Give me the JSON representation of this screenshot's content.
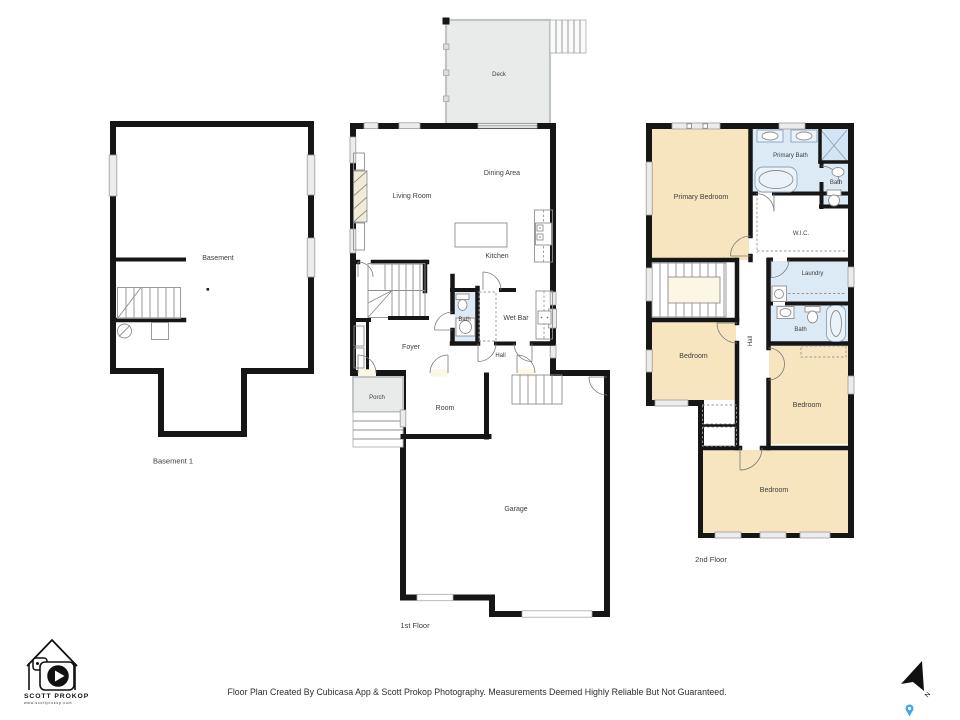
{
  "floors": {
    "basement": {
      "label": "Basement 1",
      "rooms": {
        "basement": "Basement"
      }
    },
    "first": {
      "label": "1st Floor",
      "rooms": {
        "deck": "Deck",
        "living_room": "Living Room",
        "dining_area": "Dining Area",
        "kitchen": "Kitchen",
        "bath": "Bath",
        "wet_bar": "Wet Bar",
        "foyer": "Foyer",
        "hall": "Hall",
        "porch": "Porch",
        "room": "Room",
        "garage": "Garage"
      }
    },
    "second": {
      "label": "2nd Floor",
      "rooms": {
        "primary_bedroom": "Primary Bedroom",
        "primary_bath": "Primary Bath",
        "bath_ensuite": "Bath",
        "wic": "W.I.C.",
        "laundry": "Laundry",
        "bath": "Bath",
        "bedroom_left": "Bedroom",
        "hall": "Hall",
        "bedroom_right": "Bedroom",
        "bedroom_bottom": "Bedroom"
      }
    }
  },
  "footer": {
    "disclaimer": "Floor Plan Created By Cubicasa App & Scott Prokop Photography. Measurements Deemed Highly Reliable But Not Guaranteed."
  },
  "logo": {
    "name": "SCOTT PROKOP",
    "website": "www.scottprokop.com"
  },
  "compass": {
    "north_label": "N"
  },
  "colors": {
    "room_fill": "#FBF7E4",
    "bedroom_fill": "#F6E5BE",
    "bath_fill": "#DCEAF6",
    "deck_fill": "#E9EBEB",
    "wall": "#161616",
    "pin_blue": "#41A8EE"
  }
}
